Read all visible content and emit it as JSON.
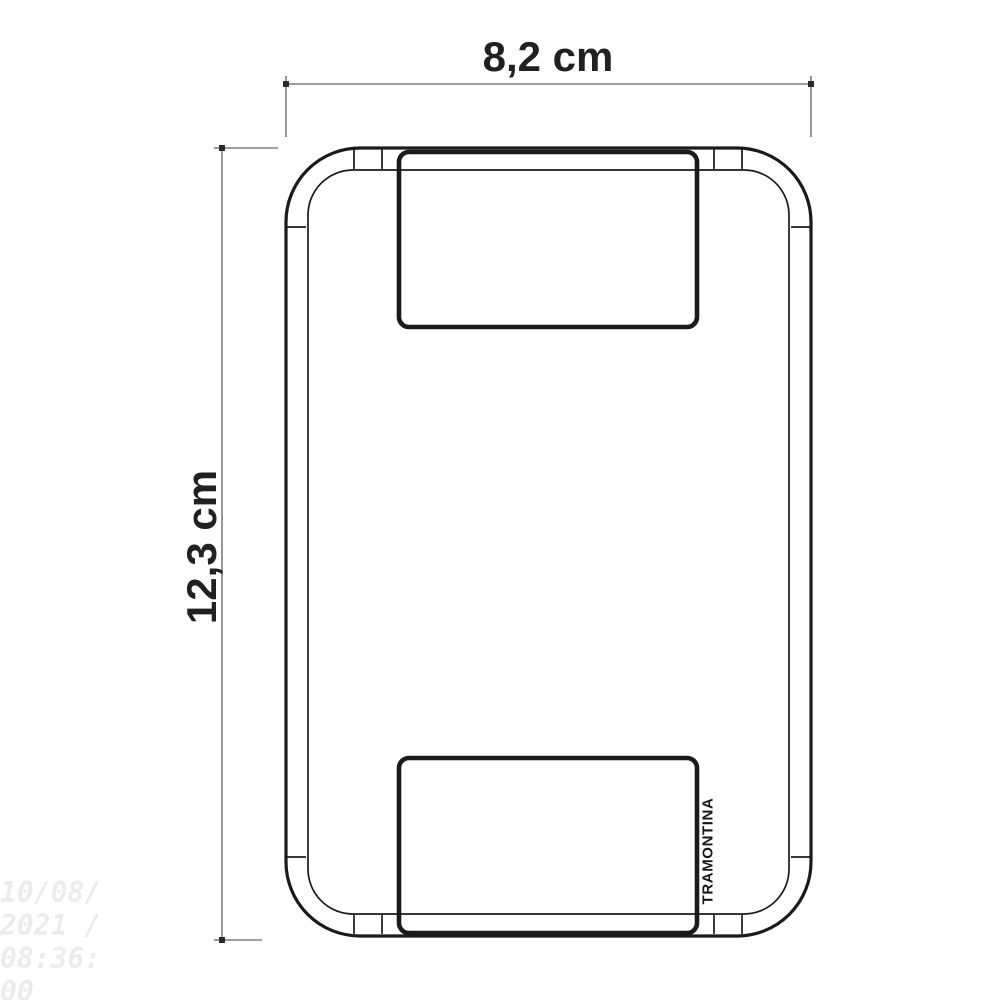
{
  "figure": {
    "type": "technical dimension drawing",
    "subject": "rectangular wall plate with two module openings, front view",
    "brand_label": "TRAMONTINA"
  },
  "dimensions": {
    "width_label": "8,2 cm",
    "height_label": "12,3 cm"
  },
  "watermark": {
    "lines": [
      "10/08/",
      "2021 /",
      "08:36:",
      "00"
    ]
  },
  "colors": {
    "background": "#ffffff",
    "line": "#1a1a1a",
    "dimension_line": "#7d7d7d",
    "endpoint_dot": "#2b2b2b",
    "label_text": "#212121",
    "watermark_text": "#ececec"
  }
}
